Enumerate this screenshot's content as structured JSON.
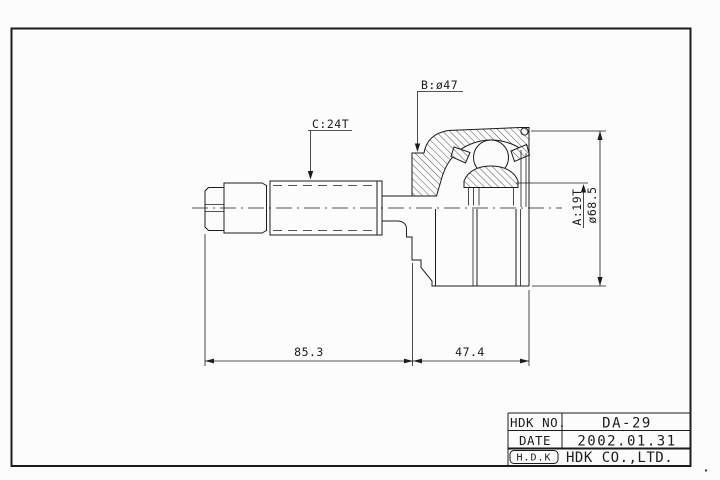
{
  "colors": {
    "line": "#1c1c1c",
    "background": "#fcfcfc"
  },
  "callouts": {
    "outer_spline": "B:ø47",
    "shaft_spline": "C:24T",
    "inner_spline": "A:19T",
    "outer_diameter": "ø68.5"
  },
  "dimensions": {
    "shaft_length": "85.3",
    "joint_length": "47.4"
  },
  "title_block": {
    "rows": [
      {
        "label": "HDK NO.",
        "value": "DA-29"
      },
      {
        "label": "DATE",
        "value": "2002.01.31"
      },
      {
        "label": "H.D.K",
        "value": "HDK CO.,LTD."
      }
    ]
  }
}
